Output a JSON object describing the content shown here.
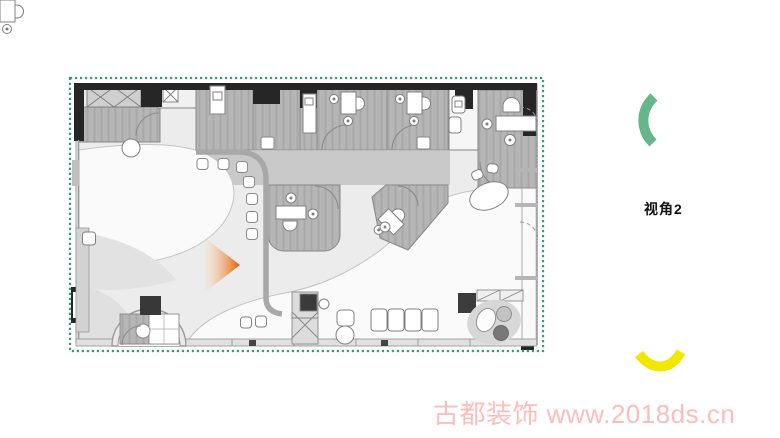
{
  "view_label": "视角2",
  "watermark_text": "古都装饰 www.2018ds.cn",
  "colors": {
    "border_green": "#2f9e70",
    "arc_green": "#66b68c",
    "arc_yellow": "#f3e600",
    "cone_light": "#f7d9bd",
    "cone_mid": "#ec8a43",
    "cone_dark": "#dd5f14",
    "wall_black": "#262626",
    "room_gray": "#b6b6b6",
    "corridor_gray": "#c9c9c9",
    "open_space_white": "#fafafa",
    "base_gray": "#ececec",
    "watermark_pink": "#ffbcbc"
  },
  "icons": {
    "view_cone": "camera-view-cone",
    "arc_top": "viewpoint-arc",
    "arc_bottom": "viewpoint-arc"
  }
}
